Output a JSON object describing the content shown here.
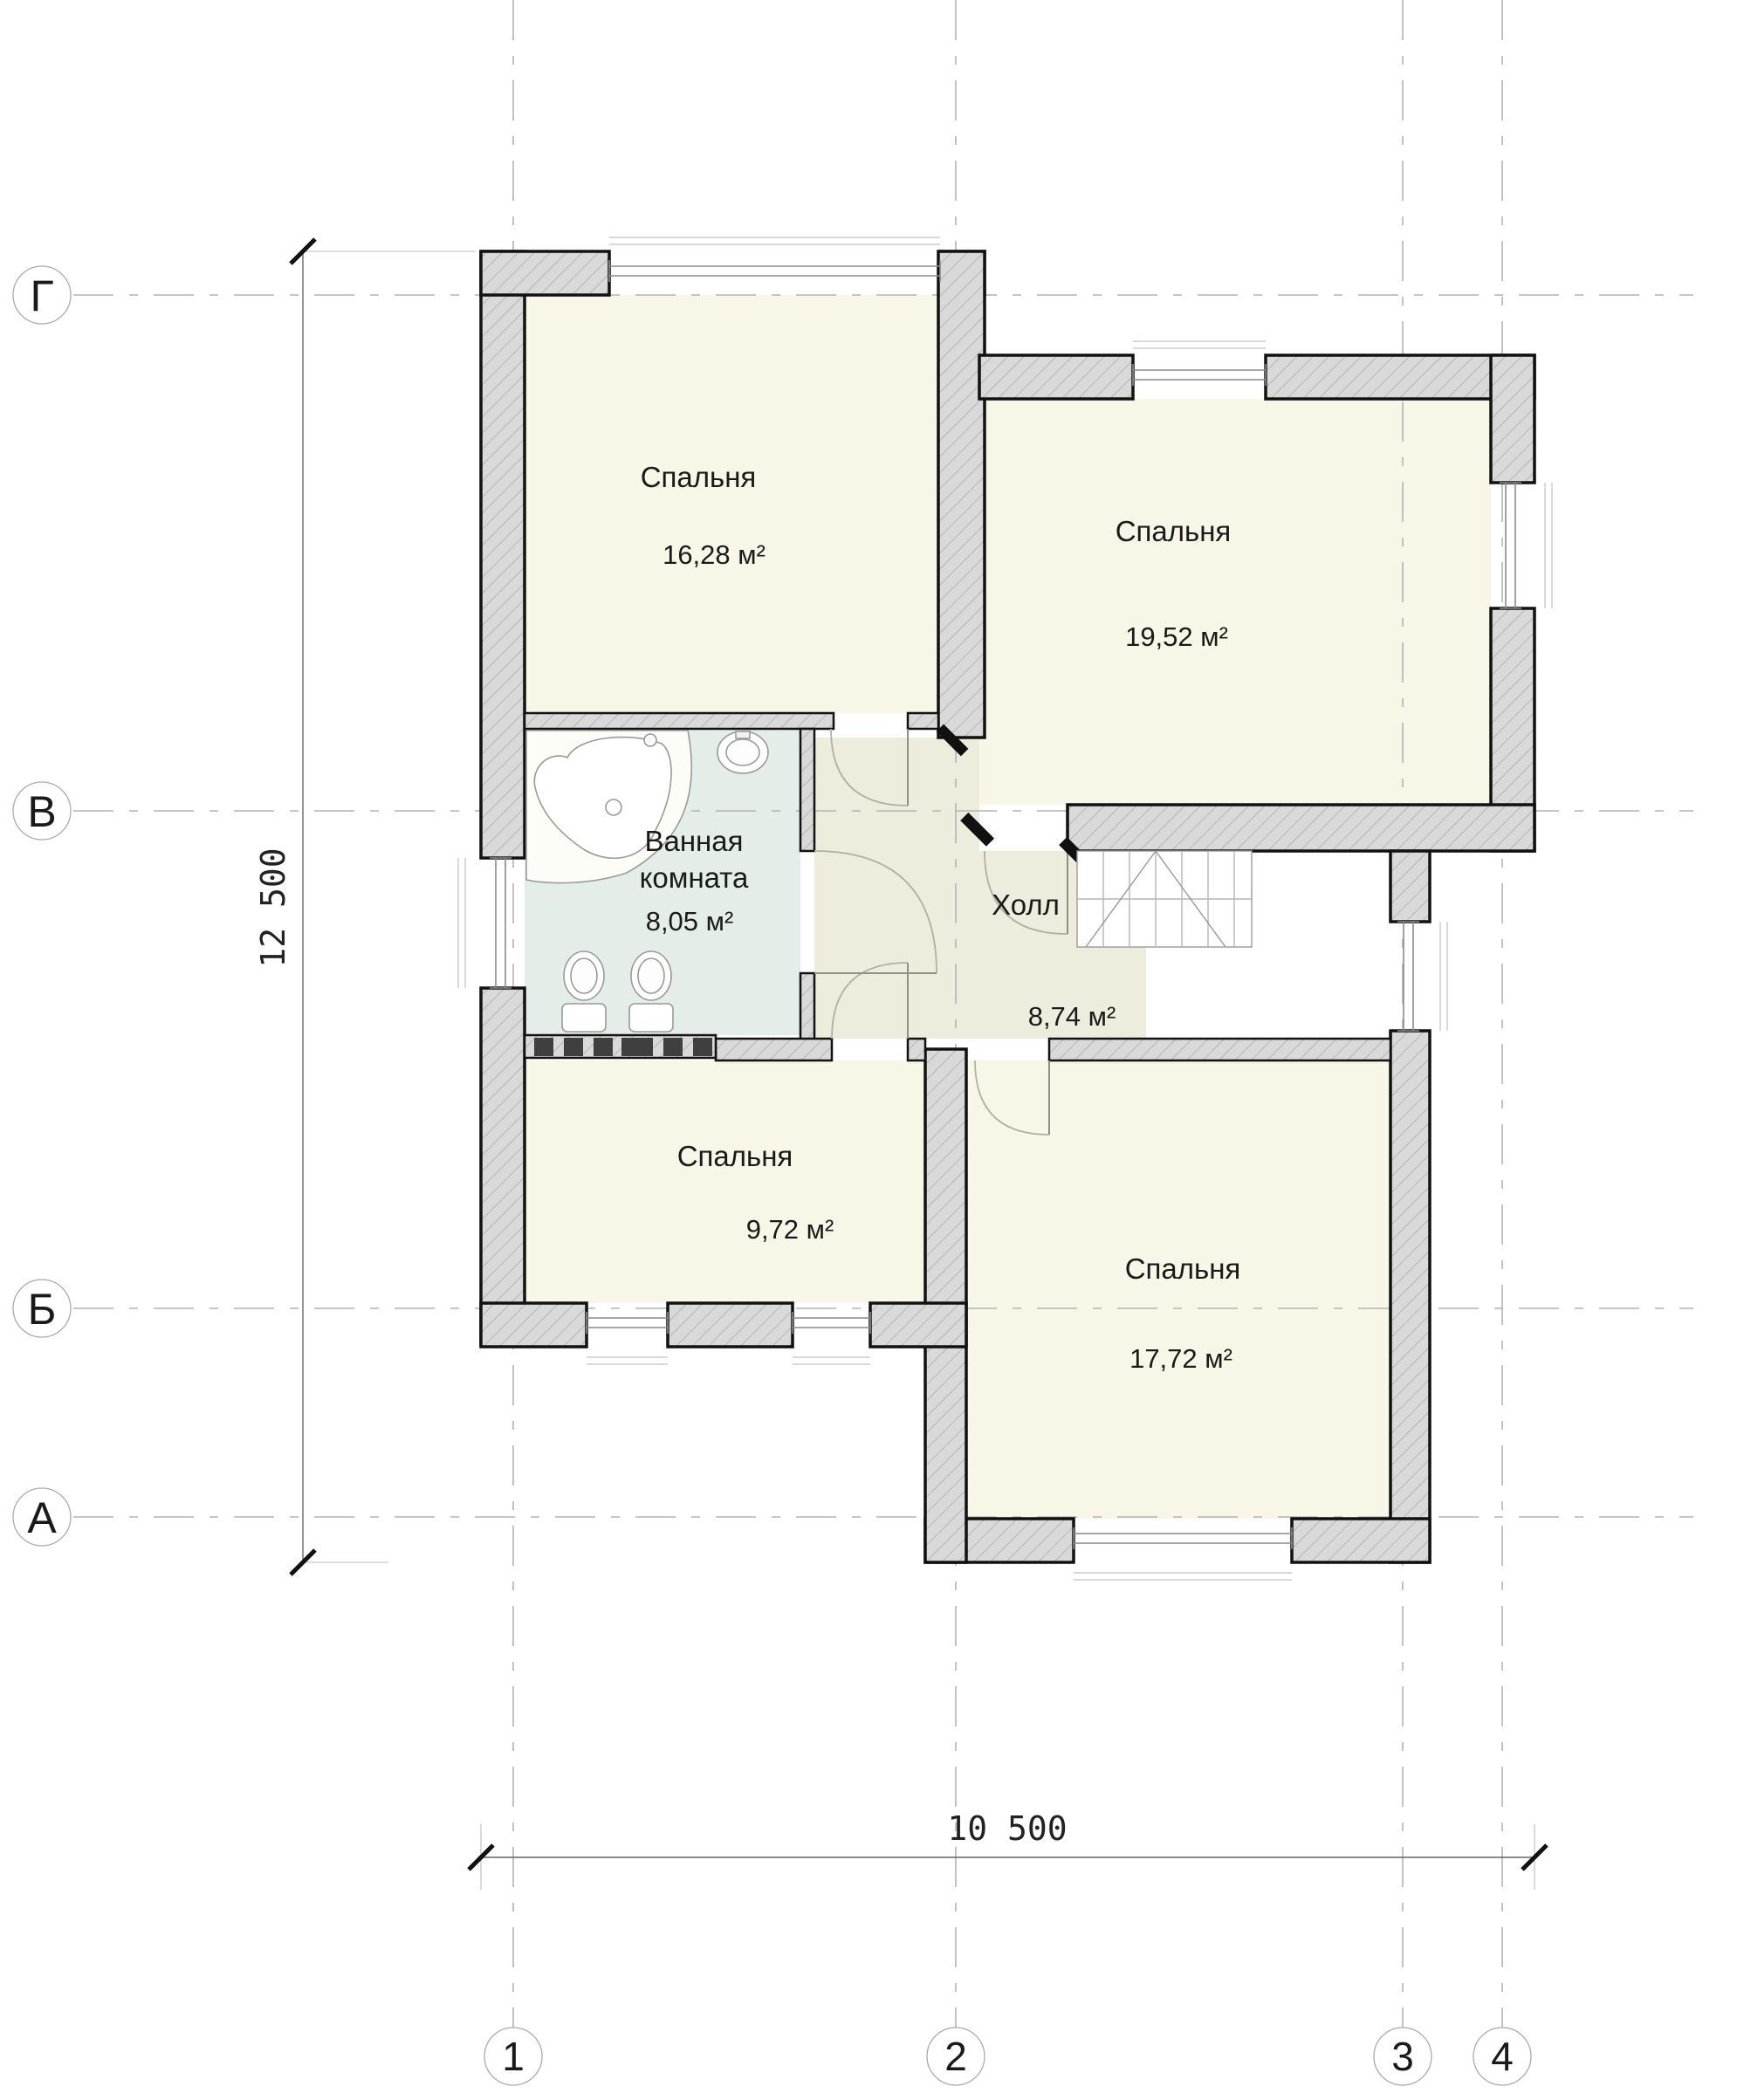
{
  "plan": {
    "title_none": "",
    "rooms": [
      {
        "key": "bedroom-top-left",
        "label": "Спальня",
        "area": "16,28 м²"
      },
      {
        "key": "bedroom-top-right",
        "label": "Спальня",
        "area": "19,52 м²"
      },
      {
        "key": "bathroom",
        "label_line1": "Ванная",
        "label_line2": "комната",
        "area": "8,05 м²"
      },
      {
        "key": "hall",
        "label": "Холл",
        "area": "8,74 м²"
      },
      {
        "key": "bedroom-bottom-left",
        "label": "Спальня",
        "area": "9,72 м²"
      },
      {
        "key": "bedroom-bottom-right",
        "label": "Спальня",
        "area": "17,72 м²"
      }
    ],
    "axes": {
      "rows": [
        {
          "label": "Г"
        },
        {
          "label": "В"
        },
        {
          "label": "Б"
        },
        {
          "label": "А"
        }
      ],
      "cols": [
        {
          "label": "1"
        },
        {
          "label": "2"
        },
        {
          "label": "3"
        },
        {
          "label": "4"
        }
      ]
    },
    "dimensions": {
      "vertical": "12 500",
      "horizontal": "10 500"
    },
    "fixtures": [
      "bathtub-icon",
      "sink-icon",
      "toilet-icon",
      "toilet-icon",
      "staircase-icon",
      "radiator-squares"
    ],
    "colors": {
      "wall_fill": "#d9d9d9",
      "wall_hatch": "#a6a6a6",
      "wall_outline": "#111111",
      "floor_bedroom": "#f7f6e7",
      "floor_bathroom": "#e4ede7",
      "floor_hall": "#edecdd",
      "grid_line": "#b3b3b3",
      "dim_line": "#666666",
      "dark_square": "#3f3f3f"
    }
  }
}
